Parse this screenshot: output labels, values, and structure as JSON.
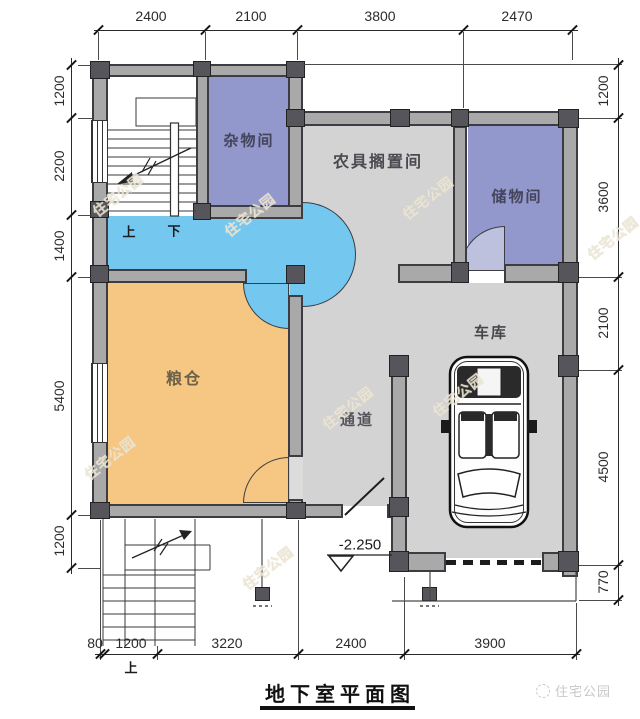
{
  "title": "地下室平面图",
  "rooms": {
    "misc_room": "杂物间",
    "farm_tool_room": "农具搁置间",
    "storage_room": "储物间",
    "grain_store": "粮仓",
    "passage": "通道",
    "garage": "车库"
  },
  "stairs": {
    "up": "上",
    "down": "下",
    "outdoor_up": "上"
  },
  "elevation": "-2.250",
  "dims": {
    "top": [
      "2400",
      "2100",
      "3800",
      "2470"
    ],
    "left": [
      "1200",
      "2200",
      "1400",
      "5400",
      "1200"
    ],
    "right": [
      "1200",
      "3600",
      "2100",
      "4500",
      "770"
    ],
    "bottom": [
      "80",
      "1200",
      "3220",
      "2400",
      "3900"
    ]
  },
  "watermark": "住宅公园",
  "footer_logo": "住宅公园",
  "colors": {
    "wall_fill": "#a9a9a9",
    "wall_line": "#3c3c42",
    "room_purple": "#9297cc",
    "room_cyan": "#74c7ee",
    "room_orange": "#f6c783",
    "room_gray": "#d3d3d3"
  }
}
